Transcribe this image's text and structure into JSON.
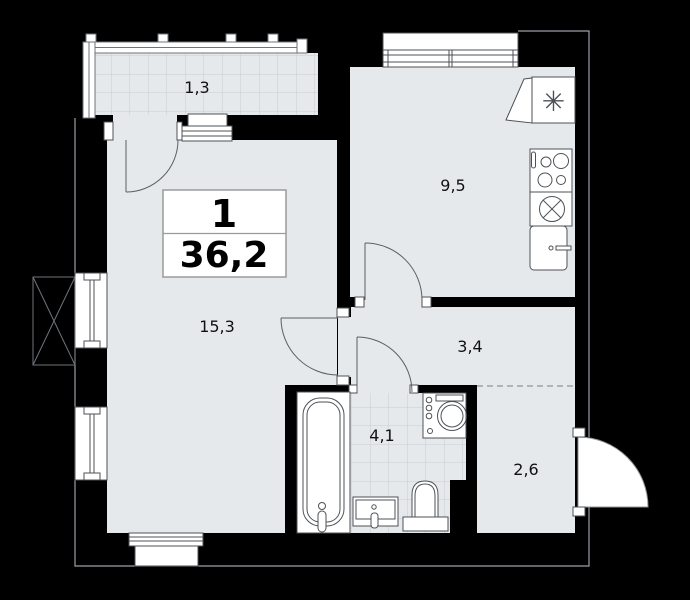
{
  "unit_card": {
    "rooms_count": "1",
    "total_area": "36,2"
  },
  "rooms": {
    "balcony": {
      "area": "1,3"
    },
    "kitchen": {
      "area": "9,5"
    },
    "living_room": {
      "area": "15,3"
    },
    "hallway": {
      "area": "3,4"
    },
    "bathroom": {
      "area": "4,1"
    },
    "entryway": {
      "area": "2,6"
    }
  },
  "icons": {
    "snowflake": "✳"
  },
  "colors": {
    "background": "#000000",
    "floor": "#e6e9ec",
    "tile_line": "#c8cdd2",
    "fixture_stroke": "#4d5156",
    "contour_line": "#9aa0a6",
    "label_text": "#111111"
  }
}
